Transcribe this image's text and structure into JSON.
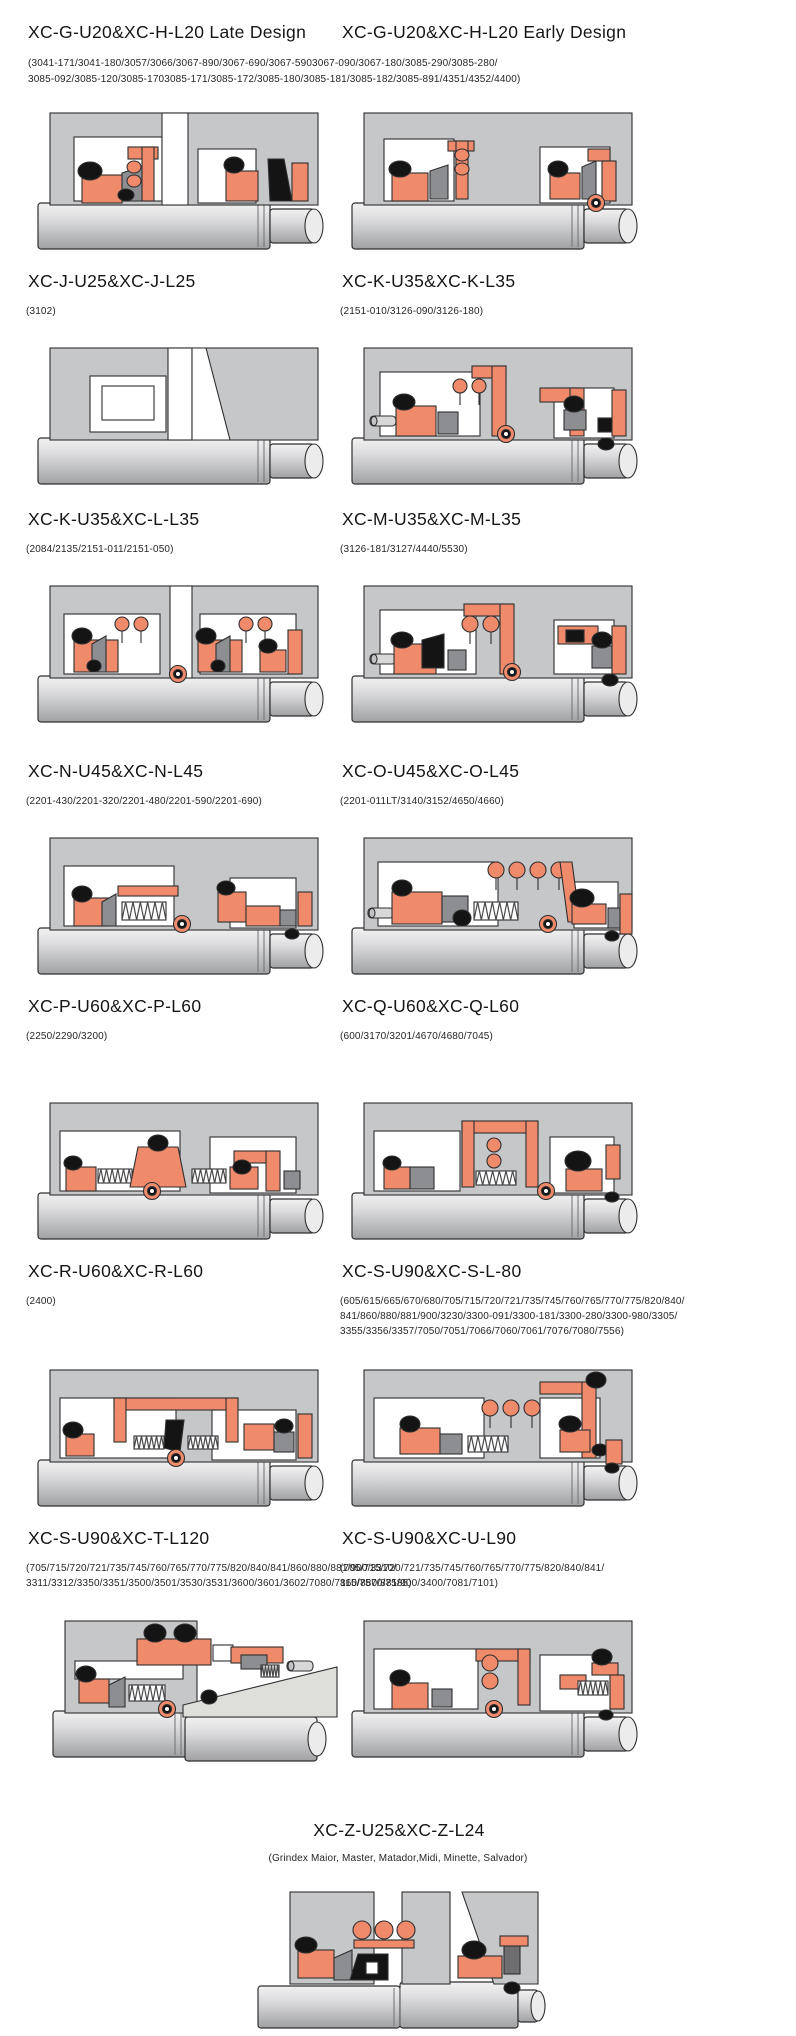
{
  "page": {
    "background": "#ffffff",
    "kind": "mechanical-seal-catalog-page"
  },
  "palette": {
    "housing_gray": "#c6c7c9",
    "seal_salmon": "#ef8a6b",
    "elastomer_black": "#141414",
    "metal_gray": "#8d8e91",
    "dark_gray": "#6e6e71",
    "shaft_light": "#f0f0f1",
    "shaft_dark": "#a3a4a6",
    "wedge_light": "#dededa",
    "outline": "#2f2f31"
  },
  "rows": [
    {
      "left": {
        "title": "XC-G-U20&XC-H-L20 Late Design",
        "diagram": "g-late"
      },
      "right": {
        "title": "XC-G-U20&XC-H-L20 Early Design",
        "diagram": "g-early"
      },
      "shared_models": [
        "(3041-171/3041-180/3057/3066/3067-890/3067-690/3067-5903067-090/3067-180/3085-290/3085-280/",
        "3085-092/3085-120/3085-1703085-171/3085-172/3085-180/3085-181/3085-182/3085-891/4351/4352/4400)"
      ]
    },
    {
      "left": {
        "title": "XC-J-U25&XC-J-L25",
        "models": [
          "(3102)"
        ],
        "diagram": "j"
      },
      "right": {
        "title": "XC-K-U35&XC-K-L35",
        "models": [
          "(2151-010/3126-090/3126-180)"
        ],
        "diagram": "k"
      }
    },
    {
      "left": {
        "title": "XC-K-U35&XC-L-L35",
        "models": [
          "(2084/2135/2151-011/2151-050)"
        ],
        "diagram": "kl"
      },
      "right": {
        "title": "XC-M-U35&XC-M-L35",
        "models": [
          "(3126-181/3127/4440/5530)"
        ],
        "diagram": "m"
      }
    },
    {
      "left": {
        "title": "XC-N-U45&XC-N-L45",
        "models": [
          "(2201-430/2201-320/2201-480/2201-590/2201-690)"
        ],
        "diagram": "n"
      },
      "right": {
        "title": "XC-O-U45&XC-O-L45",
        "models": [
          "(2201-011LT/3140/3152/4650/4660)"
        ],
        "diagram": "o"
      }
    },
    {
      "left": {
        "title": "XC-P-U60&XC-P-L60",
        "models": [
          "(2250/2290/3200)"
        ],
        "diagram": "p"
      },
      "right": {
        "title": "XC-Q-U60&XC-Q-L60",
        "models": [
          "(600/3170/3201/4670/4680/7045)"
        ],
        "diagram": "q"
      }
    },
    {
      "left": {
        "title": "XC-R-U60&XC-R-L60",
        "models": [
          "(2400)"
        ],
        "diagram": "r"
      },
      "right": {
        "title": "XC-S-U90&XC-S-L-80",
        "models": [
          "(605/615/665/670/680/705/715/720/721/735/745/760/765/770/775/820/840/",
          "841/860/880/881/900/3230/3300-091/3300-181/3300-280/3300-980/3305/",
          "3355/3356/3357/7050/7051/7066/7060/7061/7076/7080/7556)"
        ],
        "diagram": "s"
      }
    },
    {
      "left": {
        "title": "XC-S-U90&XC-T-L120",
        "models": [
          "(705/715/720/721/735/745/760/765/770/775/820/840/841/860/880/881/900/3310/",
          "3311/3312/3350/3351/3500/3501/3530/3531/3600/3601/3602/7080/7115/7570/7585)"
        ],
        "diagram": "t"
      },
      "right": {
        "title": "XC-S-U90&XC-U-L90",
        "models": [
          "(705/715/720/721/735/745/760/765/770/775/820/840/841/",
          "860/880/881/900/3400/7081/7101)"
        ],
        "diagram": "u"
      }
    }
  ],
  "bottom": {
    "title": "XC-Z-U25&XC-Z-L24",
    "models": [
      "(Grindex  Maior, Master, Matador,Midi, Minette, Salvador)"
    ],
    "diagram": "z"
  }
}
